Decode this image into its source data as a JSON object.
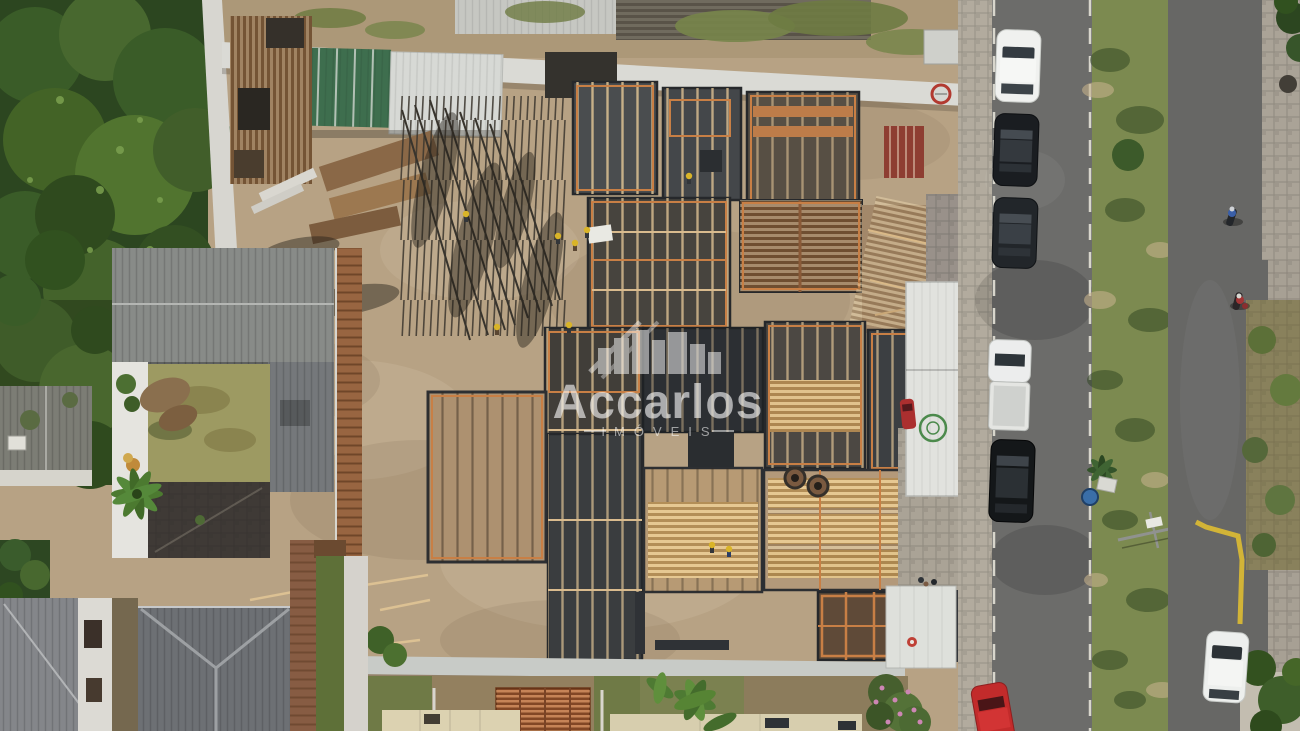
{
  "watermark": {
    "brand": "Accarlos",
    "subtitle": "IMÓVEIS",
    "logo": "city-skyline-icon"
  },
  "palette": {
    "sand": "#b7a284",
    "sand_dark": "#ac9878",
    "concrete": "#45484a",
    "concrete_dark": "#2c2f33",
    "wood_orange": "#c87f45",
    "lumber": "#d2ac6d",
    "canopy": "#2c4620",
    "grass_median": "#7c8a50",
    "lawn": "#9d9a62",
    "roof_gray": "#888b88",
    "roof_hip": "#6d7074",
    "roof_green": "#3e6e4e",
    "roof_white": "#d7d9d5",
    "roof_cream": "#dcd2b1",
    "tiles": "#a85f35",
    "road": "#6c6c6a",
    "road_right": "#676765",
    "sidewalk": "#b2ab9e",
    "wall_white": "#dadad5",
    "shed_white": "#e1e2de",
    "barrel_blue": "#3a6ea8",
    "curb_yellow": "#d2b437",
    "watermark_white": "#ffffff"
  },
  "objects": {
    "vehicles": [
      {
        "name": "white-car-top",
        "color": "#f0f1ef"
      },
      {
        "name": "black-car-upper",
        "color": "#1a1d21"
      },
      {
        "name": "black-car-mid",
        "color": "#22262a"
      },
      {
        "name": "white-pickup",
        "color": "#eceded"
      },
      {
        "name": "black-suv",
        "color": "#141719"
      },
      {
        "name": "red-car",
        "color": "#c22b2b"
      },
      {
        "name": "white-hatchback",
        "color": "#edefed"
      },
      {
        "name": "motorcycle-blue-rider",
        "color": "#3a5fa8"
      },
      {
        "name": "motorcycle-red-rider",
        "color": "#a13535"
      }
    ]
  }
}
